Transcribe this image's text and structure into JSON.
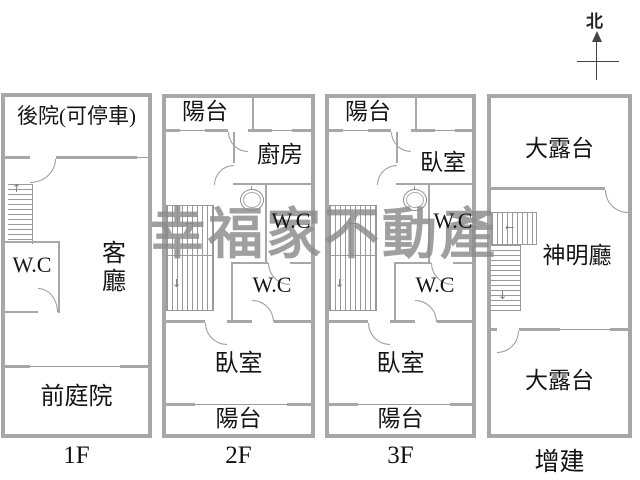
{
  "compass": {
    "north_label": "北"
  },
  "watermark": {
    "text": "幸福家不動產"
  },
  "icons": {
    "up_arrow": "↑",
    "down_arrow": "↓",
    "left_arrow": "←"
  },
  "colors": {
    "wall": "#a7a7a7",
    "line": "#9c9c9c",
    "text": "#151515",
    "watermark": "#8b8b8b"
  },
  "floors": [
    {
      "name": "1F",
      "label": "1F",
      "rooms": {
        "backyard": "後院(可停車)",
        "living_room": "客廳",
        "wc": "W.C",
        "front_yard": "前庭院"
      }
    },
    {
      "name": "2F",
      "label": "2F",
      "rooms": {
        "balcony_top": "陽台",
        "kitchen": "廚房",
        "wc_upper": "W.C",
        "wc_lower": "W.C",
        "bedroom": "臥室",
        "balcony_bottom": "陽台"
      }
    },
    {
      "name": "3F",
      "label": "3F",
      "rooms": {
        "balcony_top": "陽台",
        "bedroom_upper": "臥室",
        "wc_upper": "W.C",
        "wc_lower": "W.C",
        "bedroom": "臥室",
        "balcony_bottom": "陽台"
      }
    },
    {
      "name": "annex",
      "label": "增建",
      "rooms": {
        "terrace_top": "大露台",
        "shrine_hall": "神明廳",
        "terrace_bottom": "大露台"
      }
    }
  ]
}
